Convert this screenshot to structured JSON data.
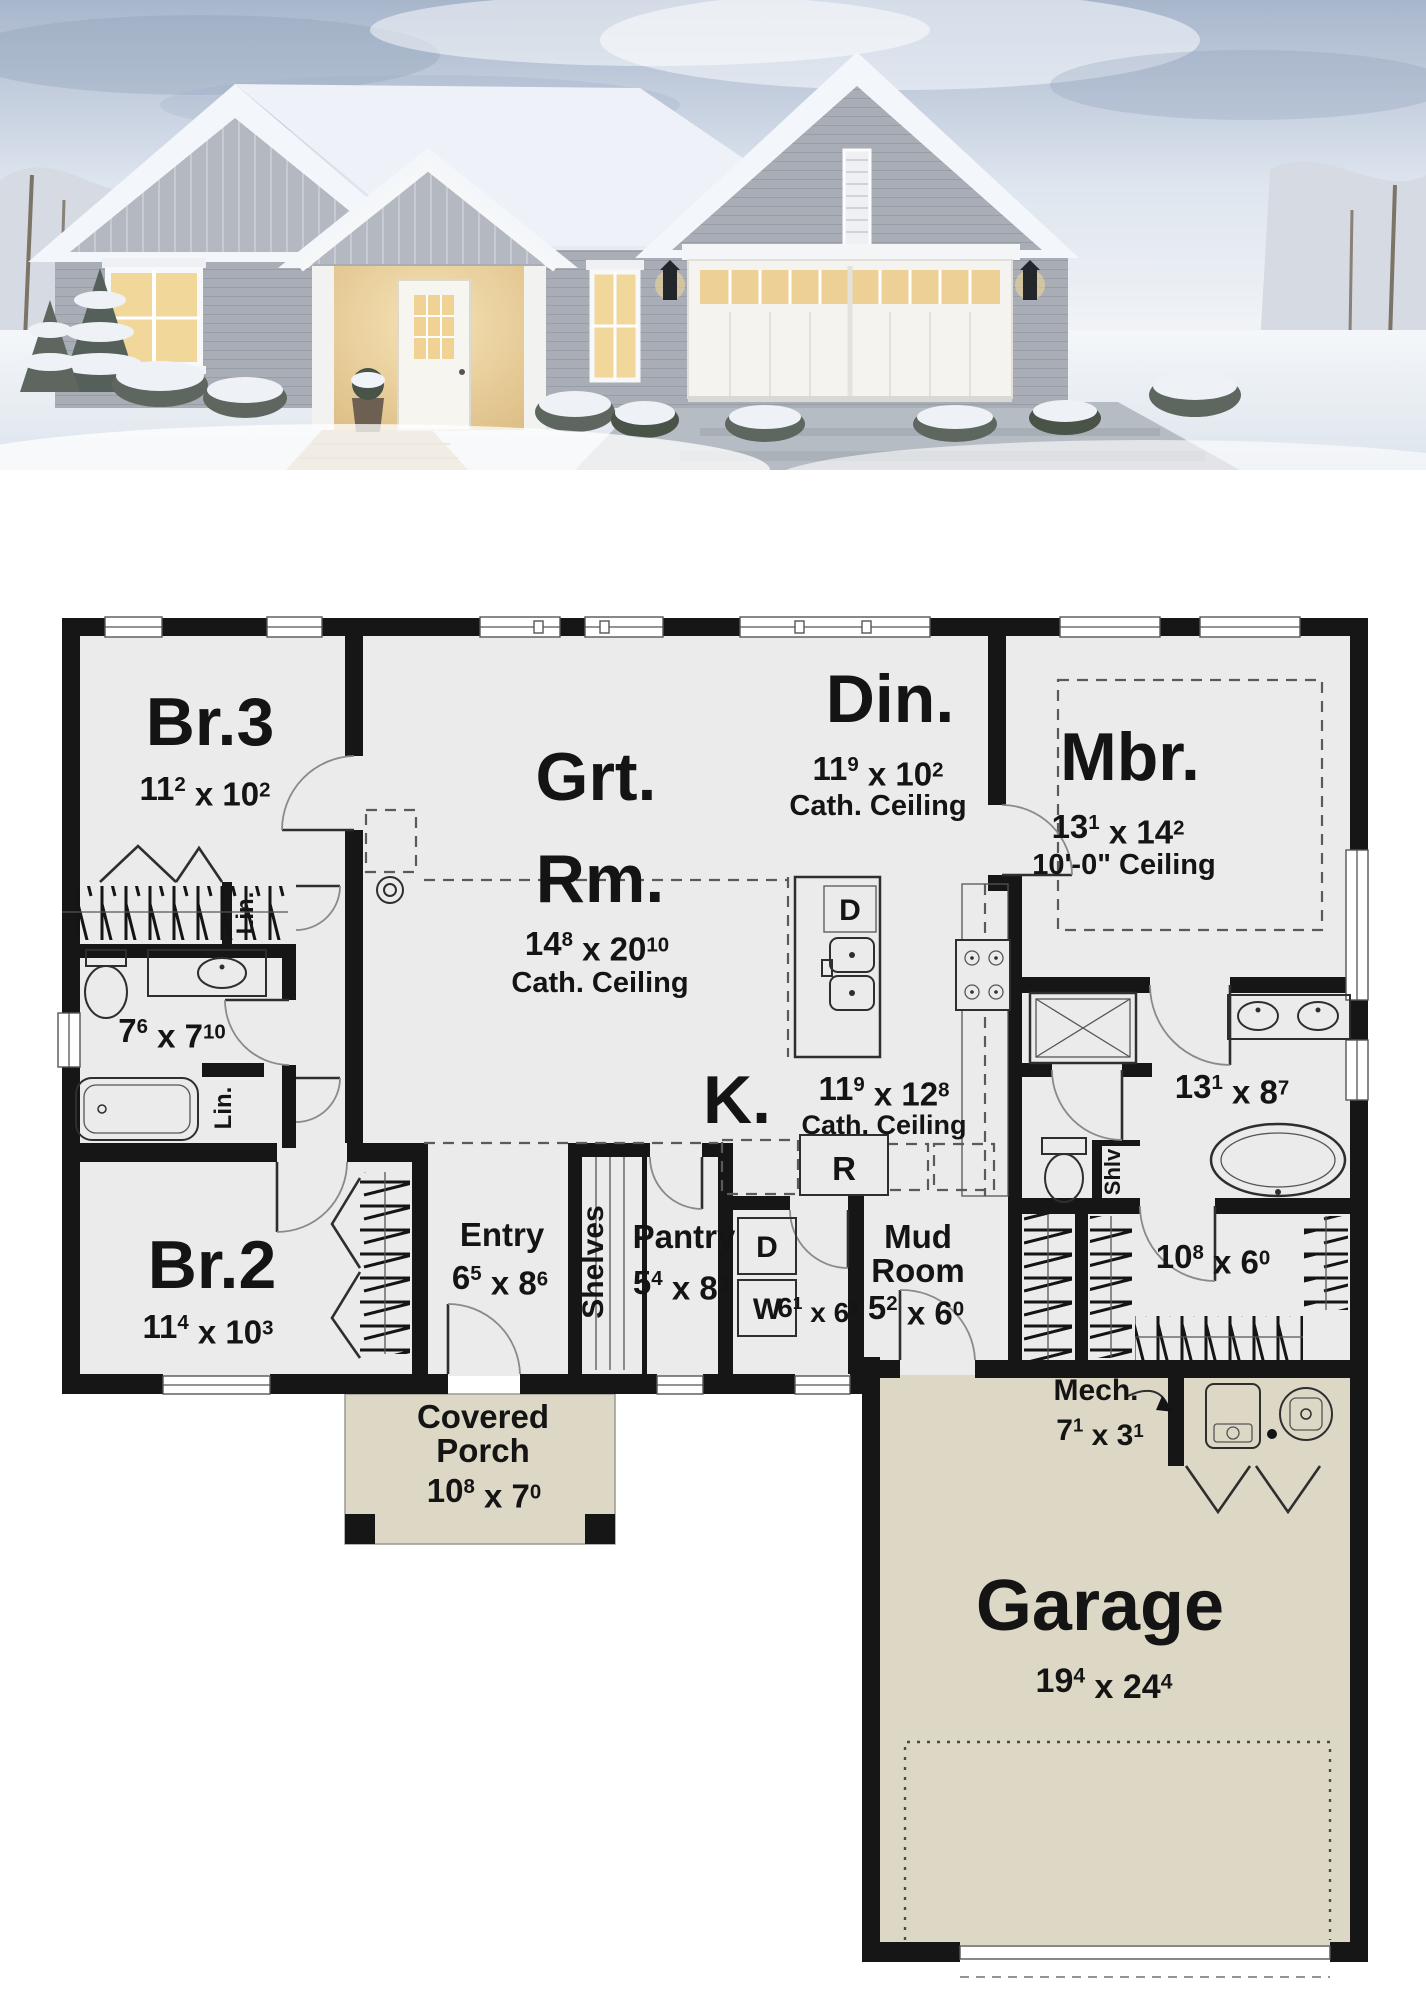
{
  "photo": {
    "description": "Snow-covered single-story gray farmhouse at dusk with lit windows, covered entry porch and attached two-car garage",
    "colors": {
      "sky_top": "#a8b6cc",
      "sky_bottom": "#f2f4f7",
      "siding": "#a9adb5",
      "gable": "#b6bac2",
      "trim": "#f5f6f7",
      "snow_roof": "#f3f6fa",
      "window_glow": "#f0d79b",
      "driveway": "#b6bcc4",
      "walkway": "#c7b795"
    }
  },
  "plan": {
    "colors": {
      "wall": "#161616",
      "floor": "#ebebeb",
      "outdoor": "#ddd8c5",
      "page": "#ffffff"
    },
    "rooms": {
      "br3": {
        "name": "Br.3",
        "dims": "11^2 x 10^2"
      },
      "grt": {
        "line1": "Grt.",
        "line2": "Rm.",
        "dims": "14^8 x 20^10",
        "ceiling": "Cath. Ceiling"
      },
      "din": {
        "name": "Din.",
        "dims": "11^9 x 10^2",
        "ceiling": "Cath. Ceiling"
      },
      "mbr": {
        "name": "Mbr.",
        "dims": "13^1 x 14^2",
        "ceiling": "10'-0\" Ceiling"
      },
      "bath": {
        "dims": "7^6 x 7^10"
      },
      "kitchen": {
        "name": "K.",
        "dims": "11^9 x 12^8",
        "ceiling": "Cath. Ceiling"
      },
      "mbath": {
        "dims": "13^1 x 8^7"
      },
      "br2": {
        "name": "Br.2",
        "dims": "11^4 x 10^3"
      },
      "entry": {
        "name": "Entry",
        "dims": "6^5 x 8^6"
      },
      "shelves": {
        "name": "Shelves"
      },
      "pantry": {
        "name": "Pantry",
        "dims": "5^4 x 8^3"
      },
      "laundry": {
        "dims": "6^1 x 6^3",
        "washer": "W",
        "dryer": "D"
      },
      "mud": {
        "line1": "Mud",
        "line2": "Room",
        "dims": "5^2 x 6^0"
      },
      "wic": {
        "dims": "10^8 x 6^0"
      },
      "mech": {
        "name": "Mech.",
        "dims": "7^1 x 3^1"
      },
      "porch": {
        "line1": "Covered",
        "line2": "Porch",
        "dims": "10^8 x 7^0"
      },
      "garage": {
        "name": "Garage",
        "dims": "19^4 x 24^4"
      },
      "lin1": {
        "name": "Lin."
      },
      "lin2": {
        "name": "Lin."
      },
      "shlv": {
        "name": "Shlv"
      },
      "island": {
        "dishwasher": "D"
      },
      "fridge": {
        "label": "R"
      }
    }
  }
}
